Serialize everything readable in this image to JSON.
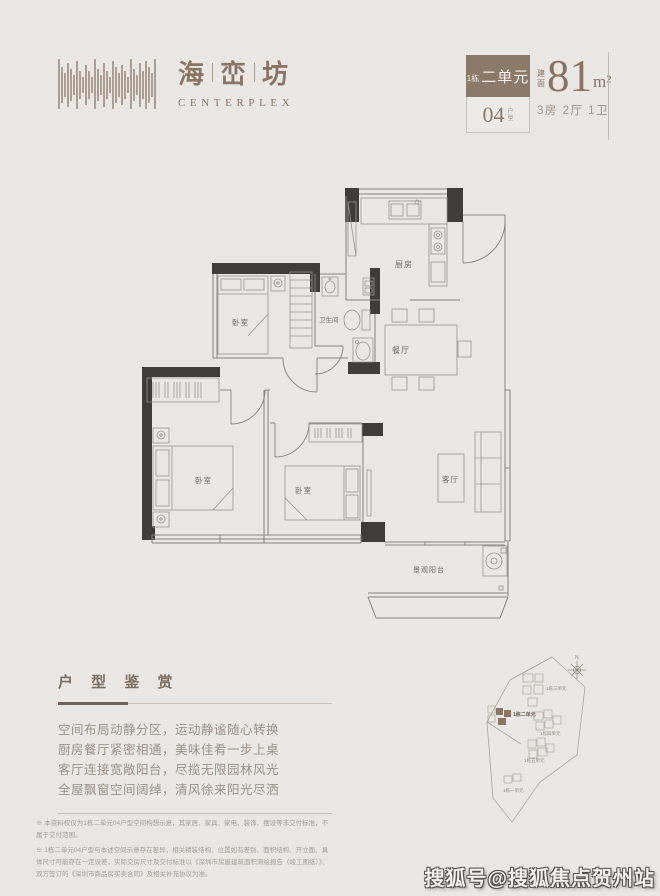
{
  "brand": {
    "chars": [
      "海",
      "峦",
      "坊"
    ],
    "subtitle": "CENTERPLEX"
  },
  "unit_badge": {
    "building_prefix": "1栋",
    "unit_name": "二单元",
    "type_number": "04",
    "type_suffix_chars": [
      "户",
      "型"
    ]
  },
  "area_info": {
    "prefix_chars": [
      "建",
      "面"
    ],
    "value": "81",
    "unit": "m²",
    "layout": "3房 2厅 1卫"
  },
  "floorplan": {
    "rooms": {
      "kitchen": "厨房",
      "bathroom": "卫生间",
      "dining": "餐厅",
      "bedroom": "卧室",
      "living": "客厅",
      "balcony": "景观阳台"
    }
  },
  "appreciation": {
    "title": "户 型 鉴 赏",
    "lines": [
      "空间布局动静分区，运动静谧随心转换",
      "厨房餐厅紧密相通，美味佳肴一步上桌",
      "客厅连接宽敞阳台，尽揽无限园林风光",
      "全屋飘窗空间阔绰，清风徐来阳光尽洒"
    ]
  },
  "disclaimer": {
    "note1": "※ 本资料权仅为1栋二单元04户型空间构想示意，其家居、家具、家电、装饰、摆设等非交付标准，不属于交付范围。",
    "note2": "※ 1栋二单元04户型与本述空间示意存在差异，相关精装结构、位置如有差别、面积结构、开立面、具体尺寸可能存在一定误差，实际交房尺寸及交付标准以《深圳市房屋建筑面积测绘报告（竣工图纸）》、双方签订的《深圳市商品房买卖合同》及相关补充协议为准。"
  },
  "siteplan": {
    "compass": "N",
    "labels": {
      "unit3": "1栋三单元",
      "unit2": "1栋二单元",
      "unit4": "1栋四单元",
      "unit5": "1栋五单元",
      "unit1": "1栋一单元"
    }
  },
  "watermark": "搜狐号@搜狐焦点贺州站",
  "colors": {
    "accent_brown": "#8a7463",
    "badge_brown": "#8c7a68",
    "wall_dark": "#3f3d3a",
    "background": "#e9e7e4"
  }
}
